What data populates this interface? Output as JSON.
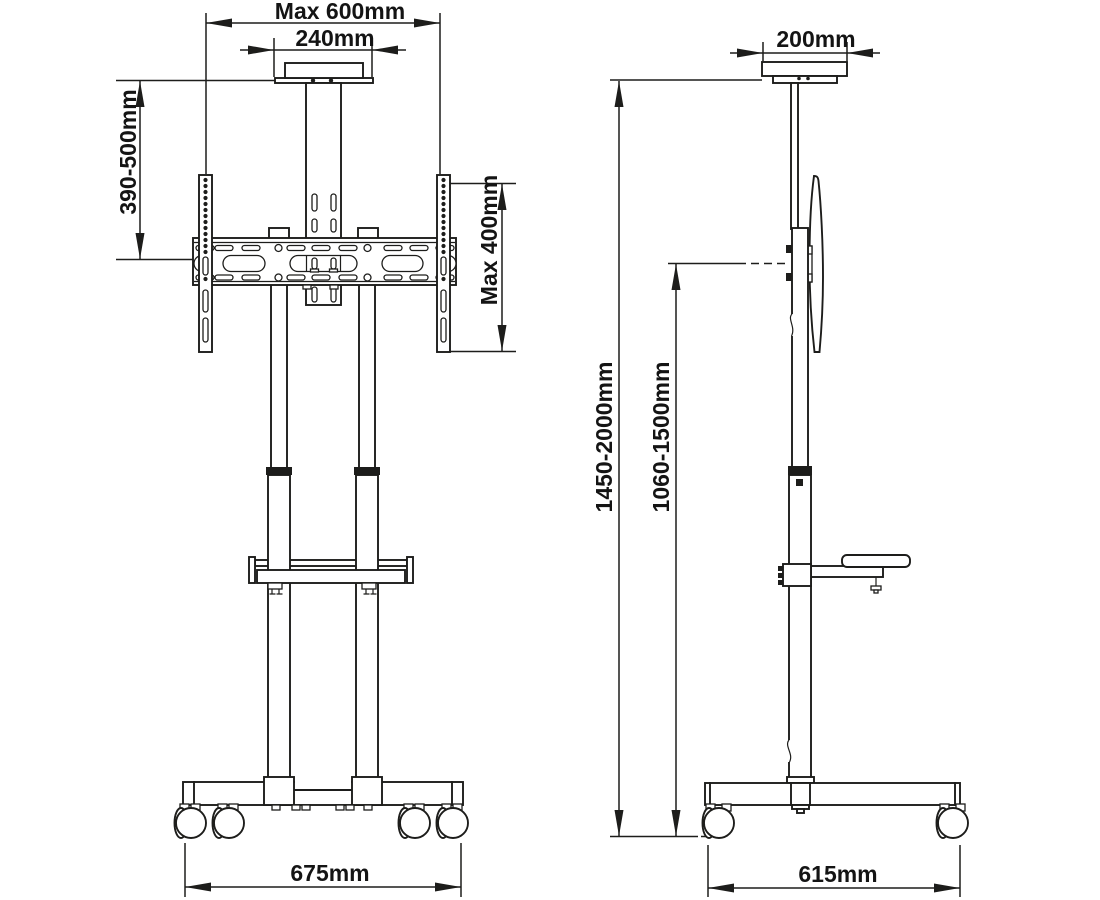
{
  "drawing": {
    "type": "product-dimension-diagram",
    "subject": "mobile-tv-cart-stand",
    "colors": {
      "line": "#1d1d1b",
      "background": "#ffffff",
      "text": "#141414"
    },
    "front_view": {
      "labels": {
        "max_width": "Max 600mm",
        "top_plate_width": "240mm",
        "mount_drop_range": "390-500mm",
        "vesa_max_height": "Max 400mm",
        "base_width": "675mm"
      }
    },
    "side_view": {
      "labels": {
        "top_depth": "200mm",
        "overall_height_range": "1450-2000mm",
        "bracket_center_height_range": "1060-1500mm",
        "base_depth": "615mm"
      }
    }
  }
}
